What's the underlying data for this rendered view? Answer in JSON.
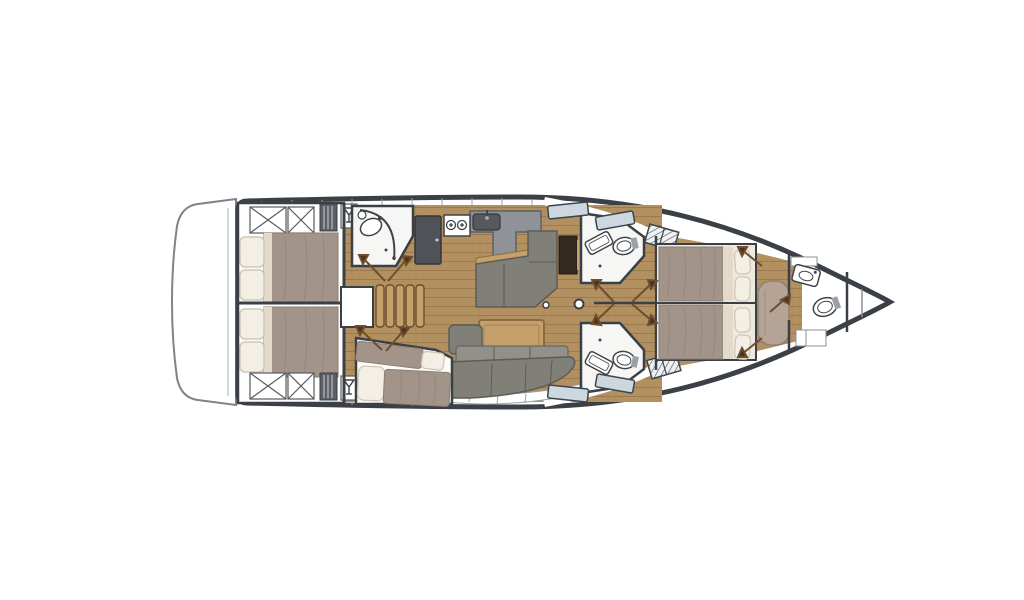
{
  "title": "Sailing yacht interior floor plan, top view, bow facing right",
  "colors": {
    "hull": "#3b4046",
    "deck": "#ffffff",
    "deck-line": "#98a0a7",
    "wood": "#b2905f",
    "wood-dark": "#9a7a4e",
    "wood-light": "#c3a06c",
    "duvet": "#a3948a",
    "duvet-dark": "#8d7e73",
    "duvet-fold": "#e3dacb",
    "pillow": "#f3efe4",
    "pillow-edge": "#cfc8b6",
    "sofa": "#807f78",
    "sofa-dark": "#5d5c56",
    "sofa-light": "#91908a",
    "counter": "#8f9296",
    "counter-dark": "#565a5f",
    "appliance": "#4f5357",
    "chart-table": "#332a20",
    "table-wood": "#c6a06a",
    "table-edge": "#8a6c42",
    "bath": "#f6f6f4",
    "fixture": "#3f444a",
    "window": "#ccd7e0",
    "door": "#6e4e2e",
    "door-arrow": "#4a3420",
    "bench": "#b5a496",
    "bench-edge": "#8f8173",
    "frame": "#efe9dd"
  },
  "plan": {
    "orientation": "bow-right",
    "rooms": [
      {
        "name": "swim-platform",
        "position": "stern"
      },
      {
        "name": "aft-cabin-port",
        "berth": "double",
        "features": [
          "storage-lockers",
          "louver-locker",
          "glass-cabinet"
        ]
      },
      {
        "name": "aft-cabin-starboard",
        "berth": "double",
        "features": [
          "storage-lockers",
          "louver-locker",
          "glass-cabinet"
        ]
      },
      {
        "name": "aft-head",
        "features": [
          "curved-shower",
          "washbasin"
        ]
      },
      {
        "name": "companionway",
        "features": [
          "five-step-stairs",
          "engine-access-box"
        ]
      },
      {
        "name": "galley",
        "features": [
          "fridge",
          "two-burner-stove",
          "sink",
          "l-shaped-counter"
        ]
      },
      {
        "name": "salon",
        "features": [
          "l-shaped-settee",
          "chart-table",
          "dining-table",
          "long-sofa",
          "end-cushion",
          "mast-post"
        ]
      },
      {
        "name": "bunk-cabin",
        "berth": "two-singles"
      },
      {
        "name": "mid-head-port",
        "features": [
          "washbasin",
          "toilet",
          "deck-grate"
        ]
      },
      {
        "name": "mid-head-starboard",
        "features": [
          "washbasin",
          "toilet",
          "deck-grate"
        ]
      },
      {
        "name": "owner-cabin",
        "berth": "island-double",
        "features": [
          "four-pillows",
          "bench-seat"
        ]
      },
      {
        "name": "fore-head",
        "features": [
          "washbasin",
          "toilet",
          "lockers"
        ]
      },
      {
        "name": "bow-locker",
        "position": "bow"
      }
    ],
    "icons": [
      "wine-glass-icon",
      "stove-burner-icon",
      "faucet-icon",
      "door-swing-icon",
      "hatch-grate-icon",
      "window-pane-icon"
    ]
  }
}
